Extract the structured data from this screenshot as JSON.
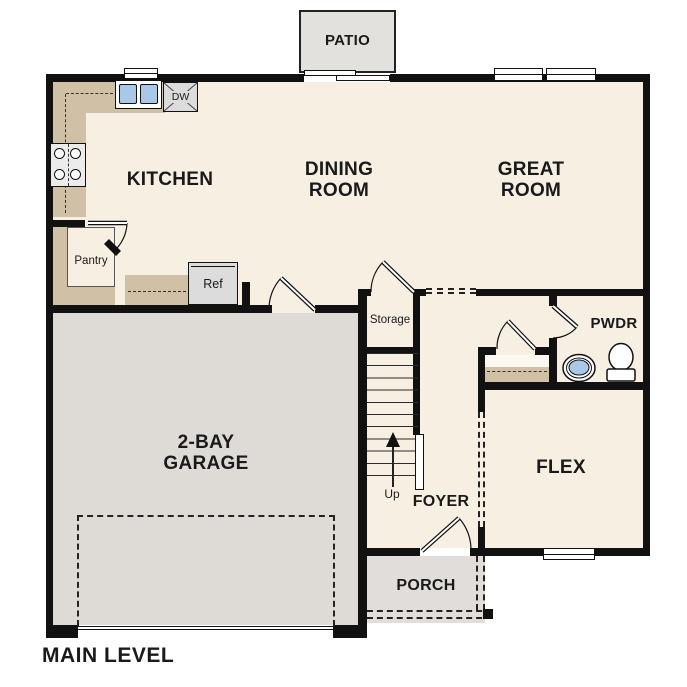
{
  "plan": {
    "title": "MAIN LEVEL",
    "rooms": {
      "patio": "PATIO",
      "kitchen": "KITCHEN",
      "dining_room": "DINING\nROOM",
      "great_room": "GREAT\nROOM",
      "pantry": "Pantry",
      "storage": "Storage",
      "powder_room": "PWDR",
      "garage": "2-BAY\nGARAGE",
      "flex": "FLEX",
      "foyer": "FOYER",
      "porch": "PORCH"
    },
    "labels": {
      "dishwasher": "DW",
      "refrigerator": "Ref",
      "stairs_up": "Up"
    },
    "colors": {
      "floor": "#f6efe2",
      "counter": "#cfc0a6",
      "garage_floor": "#dedbd7",
      "porch_floor": "#e0ddda",
      "patio_floor": "#e2e1de",
      "appliance_fill": "#dcdcdc",
      "sink_fill": "#a9c7e6",
      "wall": "#111111"
    }
  }
}
